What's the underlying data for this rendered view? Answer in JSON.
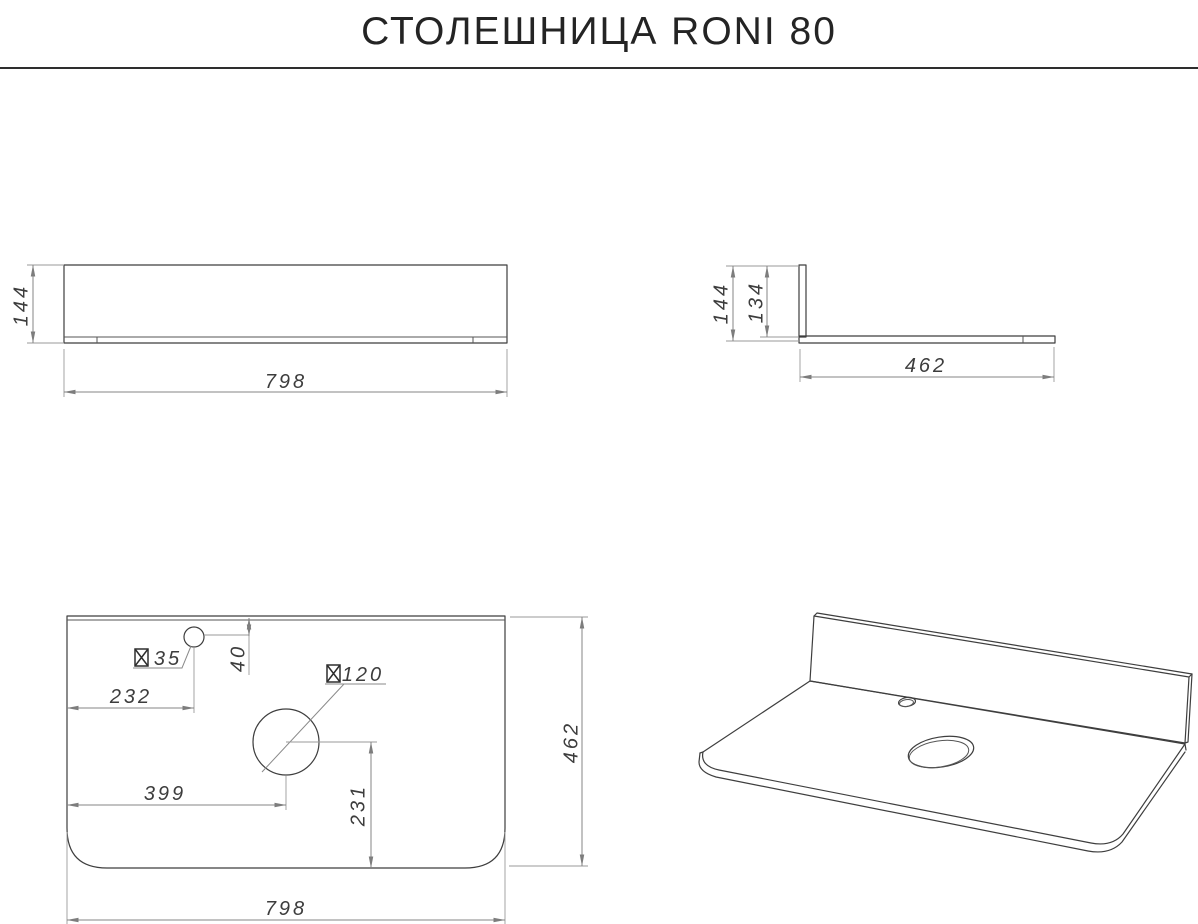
{
  "title": "СТОЛЕШНИЦА RONI 80",
  "drawing": {
    "front_view": {
      "height": "144",
      "width": "798"
    },
    "side_view": {
      "height": "144",
      "backsplash_height": "134",
      "depth": "462"
    },
    "plan_view": {
      "faucet_hole_diameter": "35",
      "faucet_hole_from_back": "40",
      "faucet_hole_from_left": "232",
      "sink_hole_diameter": "120",
      "sink_hole_from_left": "399",
      "sink_hole_from_front": "231",
      "depth": "462",
      "width": "798"
    }
  }
}
